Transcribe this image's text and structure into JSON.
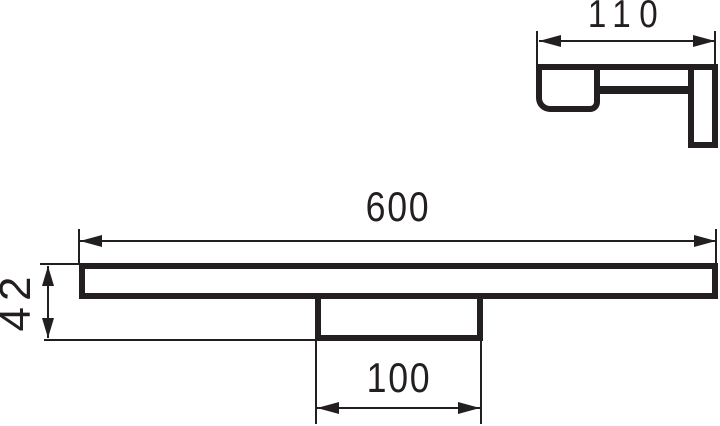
{
  "drawing": {
    "background": "#ffffff",
    "line_color": "#231f20",
    "dimensions": {
      "length": "600",
      "height": "42",
      "bracket_width": "100",
      "depth": "110"
    }
  }
}
